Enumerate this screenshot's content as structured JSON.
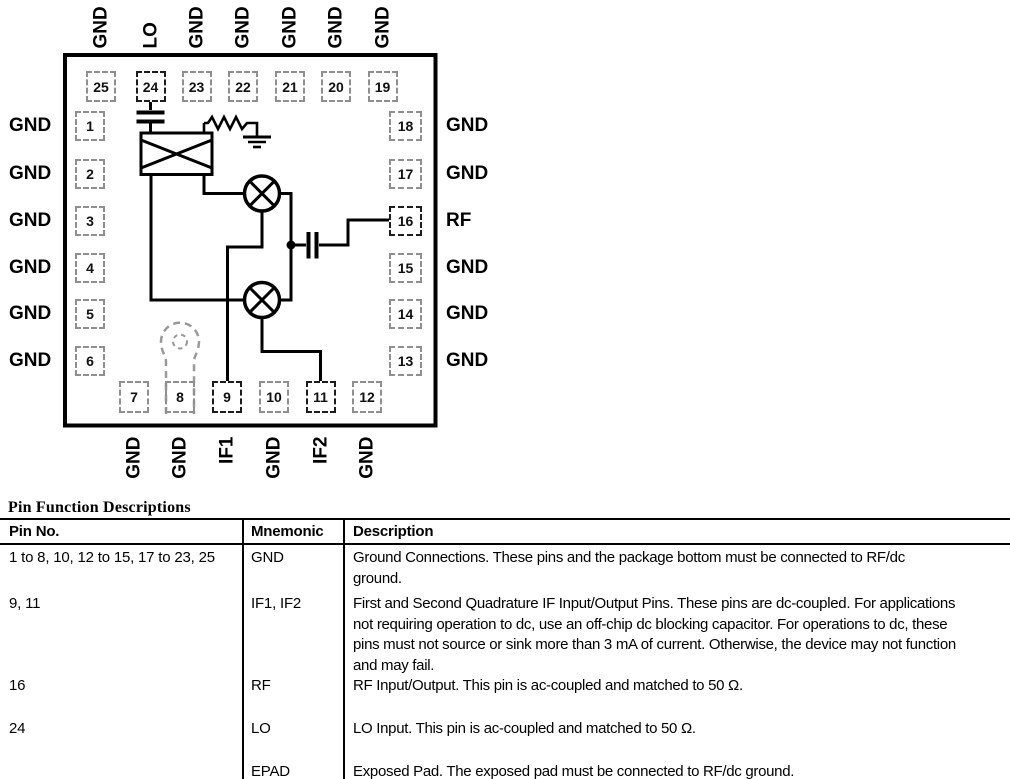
{
  "diagram": {
    "top_pins": [
      {
        "num": "25",
        "label": "GND",
        "signal": false
      },
      {
        "num": "24",
        "label": "LO",
        "signal": true
      },
      {
        "num": "23",
        "label": "GND",
        "signal": false
      },
      {
        "num": "22",
        "label": "GND",
        "signal": false
      },
      {
        "num": "21",
        "label": "GND",
        "signal": false
      },
      {
        "num": "20",
        "label": "GND",
        "signal": false
      },
      {
        "num": "19",
        "label": "GND",
        "signal": false
      }
    ],
    "left_pins": [
      {
        "num": "1",
        "label": "GND",
        "signal": false
      },
      {
        "num": "2",
        "label": "GND",
        "signal": false
      },
      {
        "num": "3",
        "label": "GND",
        "signal": false
      },
      {
        "num": "4",
        "label": "GND",
        "signal": false
      },
      {
        "num": "5",
        "label": "GND",
        "signal": false
      },
      {
        "num": "6",
        "label": "GND",
        "signal": false
      }
    ],
    "right_pins": [
      {
        "num": "18",
        "label": "GND",
        "signal": false
      },
      {
        "num": "17",
        "label": "GND",
        "signal": false
      },
      {
        "num": "16",
        "label": "RF",
        "signal": true
      },
      {
        "num": "15",
        "label": "GND",
        "signal": false
      },
      {
        "num": "14",
        "label": "GND",
        "signal": false
      },
      {
        "num": "13",
        "label": "GND",
        "signal": false
      }
    ],
    "bottom_pins": [
      {
        "num": "7",
        "label": "GND",
        "signal": false
      },
      {
        "num": "8",
        "label": "GND",
        "signal": false
      },
      {
        "num": "9",
        "label": "IF1",
        "signal": true
      },
      {
        "num": "10",
        "label": "GND",
        "signal": false
      },
      {
        "num": "11",
        "label": "IF2",
        "signal": true
      },
      {
        "num": "12",
        "label": "GND",
        "signal": false
      }
    ],
    "components": [
      "lo-blocking-capacitor",
      "balun-crossover",
      "resistor",
      "ground-symbol",
      "mixer-upper",
      "mixer-lower",
      "junction-node",
      "rf-coupling-capacitor",
      "package-orientation-tab"
    ]
  },
  "table": {
    "title": "Pin Function Descriptions",
    "columns": [
      "Pin No.",
      "Mnemonic",
      "Description"
    ],
    "rows": [
      {
        "pin_no": "1 to 8, 10, 12 to 15, 17 to 23, 25",
        "mnemonic": "GND",
        "description_lines": [
          "Ground Connections. These pins and the package bottom must be connected to RF/dc",
          "ground."
        ]
      },
      {
        "pin_no": "9, 11",
        "mnemonic": "IF1, IF2",
        "description_lines": [
          "First and Second Quadrature IF Input/Output Pins. These pins are dc-coupled. For applications",
          "not requiring operation to dc, use an off-chip dc blocking capacitor. For operations to dc, these",
          "pins must not source or sink more than 3 mA of current. Otherwise, the device may not function",
          "and may fail."
        ]
      },
      {
        "pin_no": "16",
        "mnemonic": "RF",
        "description_lines": [
          "RF Input/Output. This pin is ac-coupled and matched to 50 Ω."
        ]
      },
      {
        "pin_no": "24",
        "mnemonic": "LO",
        "description_lines": [
          "LO Input. This pin is ac-coupled and matched to 50 Ω."
        ]
      },
      {
        "pin_no": "",
        "mnemonic": "EPAD",
        "description_lines": [
          "Exposed Pad. The exposed pad must be connected to RF/dc ground."
        ]
      }
    ]
  },
  "colors": {
    "ink": "#000000",
    "gnd_pin_border": "#8f8f8f",
    "signal_pin_border": "#1c1c1c",
    "tab_outline": "#999999"
  }
}
